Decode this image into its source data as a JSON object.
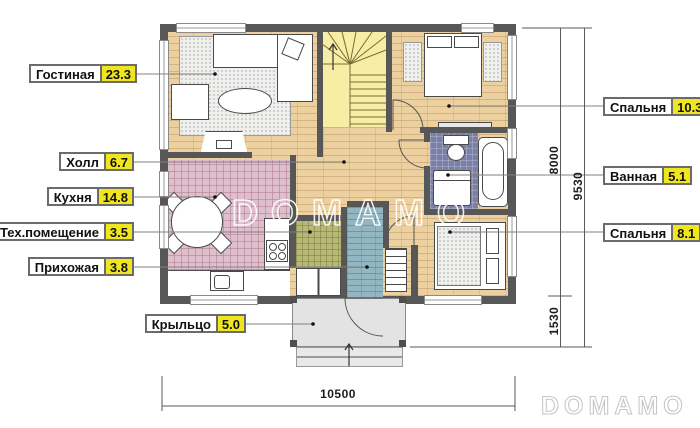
{
  "room_labels": {
    "left": [
      {
        "name": "Гостиная",
        "value": "23.3"
      },
      {
        "name": "Холл",
        "value": "6.7"
      },
      {
        "name": "Кухня",
        "value": "14.8"
      },
      {
        "name": "Тех.помещение",
        "value": "3.5"
      },
      {
        "name": "Прихожая",
        "value": "3.8"
      },
      {
        "name": "Крыльцо",
        "value": "5.0"
      }
    ],
    "right": [
      {
        "name": "Спальня",
        "value": "10.3"
      },
      {
        "name": "Ванная",
        "value": "5.1"
      },
      {
        "name": "Спальня",
        "value": "8.1"
      }
    ]
  },
  "dimensions": {
    "right_inner_top": "8000",
    "right_outer": "9530",
    "right_inner_bottom": "1530",
    "bottom": "10500"
  },
  "watermark": {
    "center": "DOMAMO",
    "corner": "DOMAMO"
  },
  "colors": {
    "accent_yellow": "#f0e620",
    "wall": "#575757",
    "wood_floor": "#ecd0a0",
    "kitchen_tile": "#debfcb",
    "tech_tile": "#b9b977",
    "entry_tile": "#92b7c3",
    "bath_tile": "#7b80a8",
    "stairs": "#f7eda4",
    "porch": "#e3e3e3"
  }
}
